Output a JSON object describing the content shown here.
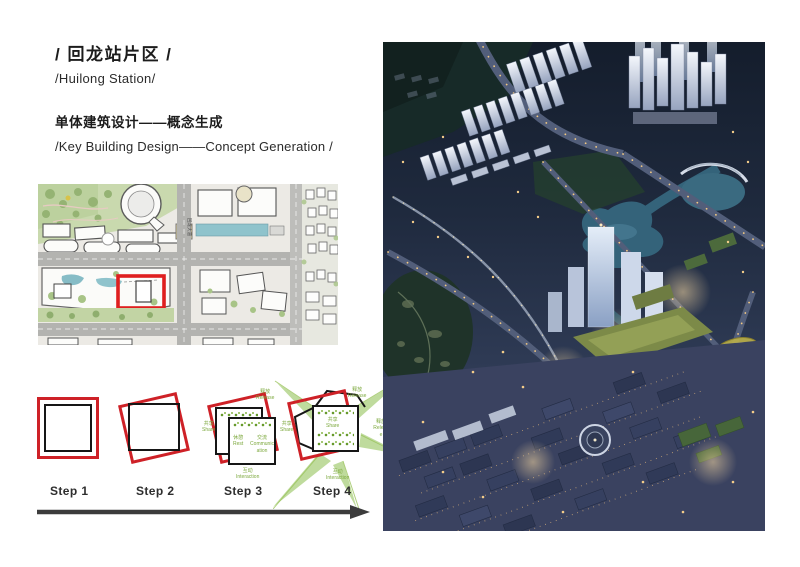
{
  "header": {
    "title_zh": "/ 回龙站片区 /",
    "title_en": "/Huilong Station/",
    "subtitle_zh": "单体建筑设计——概念生成",
    "subtitle_en": "/Key Building Design——Concept Generation /"
  },
  "site_plan": {
    "road_label": "回龙大道",
    "site_marker_color": "#df1f1f"
  },
  "steps": {
    "items": [
      {
        "label": "Step 1"
      },
      {
        "label": "Step 2"
      },
      {
        "label": "Step 3"
      },
      {
        "label": "Step 4"
      }
    ]
  },
  "concept": {
    "release_zh": "释放",
    "release_en": "Release",
    "share_zh": "共享",
    "share_en": "Share",
    "rest_zh": "休憩",
    "rest_en": "Rest",
    "comm_zh": "交流",
    "comm_en": "Communication",
    "interact_zh": "互动",
    "interact_en": "Interaction"
  },
  "colors": {
    "accent_red": "#ce2127",
    "concept_green": "#7ca83c",
    "arrow_gray": "#3c3c3c"
  }
}
